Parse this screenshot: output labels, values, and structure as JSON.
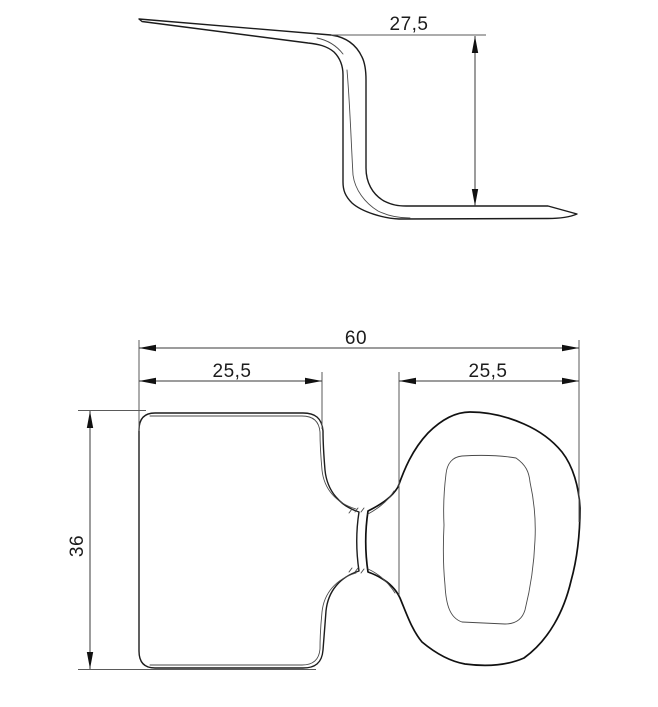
{
  "drawing": {
    "description": "Two-view technical drawing of a bent sheet-metal clip: side profile above, plan view of paddle with looped ring below",
    "colors": {
      "background": "#ffffff",
      "outline": "#1c1c1c",
      "thin_edge": "#4a4a4a",
      "dimension": "#3a3a3a"
    },
    "views": {
      "side": {
        "name": "side profile view",
        "dimensions": {
          "height": "27,5"
        }
      },
      "plan": {
        "name": "plan view",
        "dimensions": {
          "total_width": "60",
          "paddle_width": "25,5",
          "ring_width": "25,5",
          "paddle_height": "36"
        }
      }
    }
  }
}
